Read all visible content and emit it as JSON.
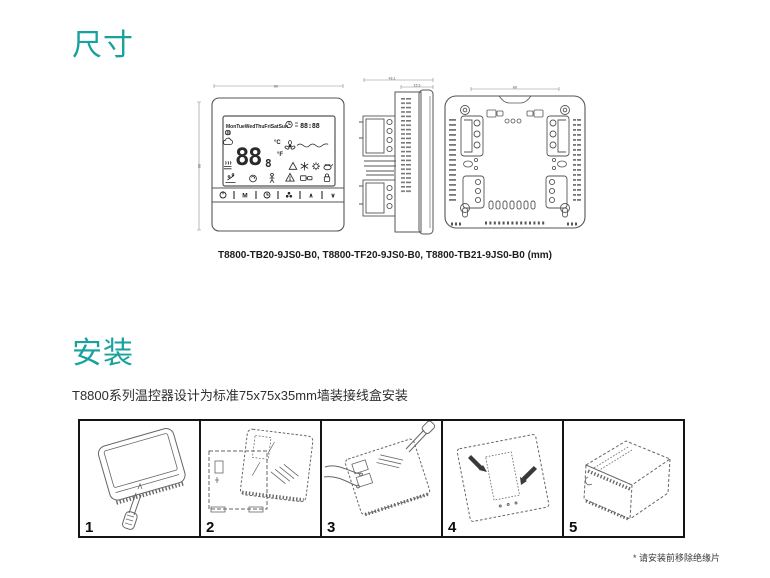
{
  "page": {
    "accent_color": "#18a29e",
    "section_dimensions_title": "尺寸",
    "section_installation_title": "安装",
    "installation_description": "T8800系列温控器设计为标准75x75x35mm墙装接线盒安装",
    "footnote": "* 请安装前移除绝缘片"
  },
  "drawings": {
    "caption": "T8800-TB20-9JS0-B0, T8800-TF20-9JS0-B0, T8800-TB21-9JS0-B0 (mm)",
    "front_view": {
      "width_label": "86",
      "height_label": "86",
      "lcd": {
        "days": "MonTueWedThuFriSatSun",
        "time": "88:88",
        "temperature_main": "88",
        "temperature_sub": "8",
        "unit_celsius": "°C",
        "unit_fahrenheit": "°F",
        "icons": [
          "radiator-icon",
          "cloud-icon",
          "floor-heat-icon",
          "clock-icon",
          "fan-wave-icon",
          "alert-triangle-icon",
          "snowflake-icon",
          "sun-icon",
          "filter-icon",
          "condensate-icon",
          "night-setback-icon",
          "occupancy-icon",
          "warning-icon",
          "keycard-icon",
          "lock-icon"
        ]
      },
      "buttons": {
        "mode_label": "M",
        "up_label": "∧",
        "down_label": "∨",
        "icon_buttons": [
          "power-icon",
          "clock-icon",
          "fan-icon"
        ]
      }
    },
    "side_view": {
      "depth_label": "43.1",
      "front_depth_label": "15.3"
    },
    "back_view": {
      "screw_spacing_label": "60"
    }
  },
  "steps": [
    {
      "number": "1"
    },
    {
      "number": "2"
    },
    {
      "number": "3"
    },
    {
      "number": "4"
    },
    {
      "number": "5"
    }
  ]
}
